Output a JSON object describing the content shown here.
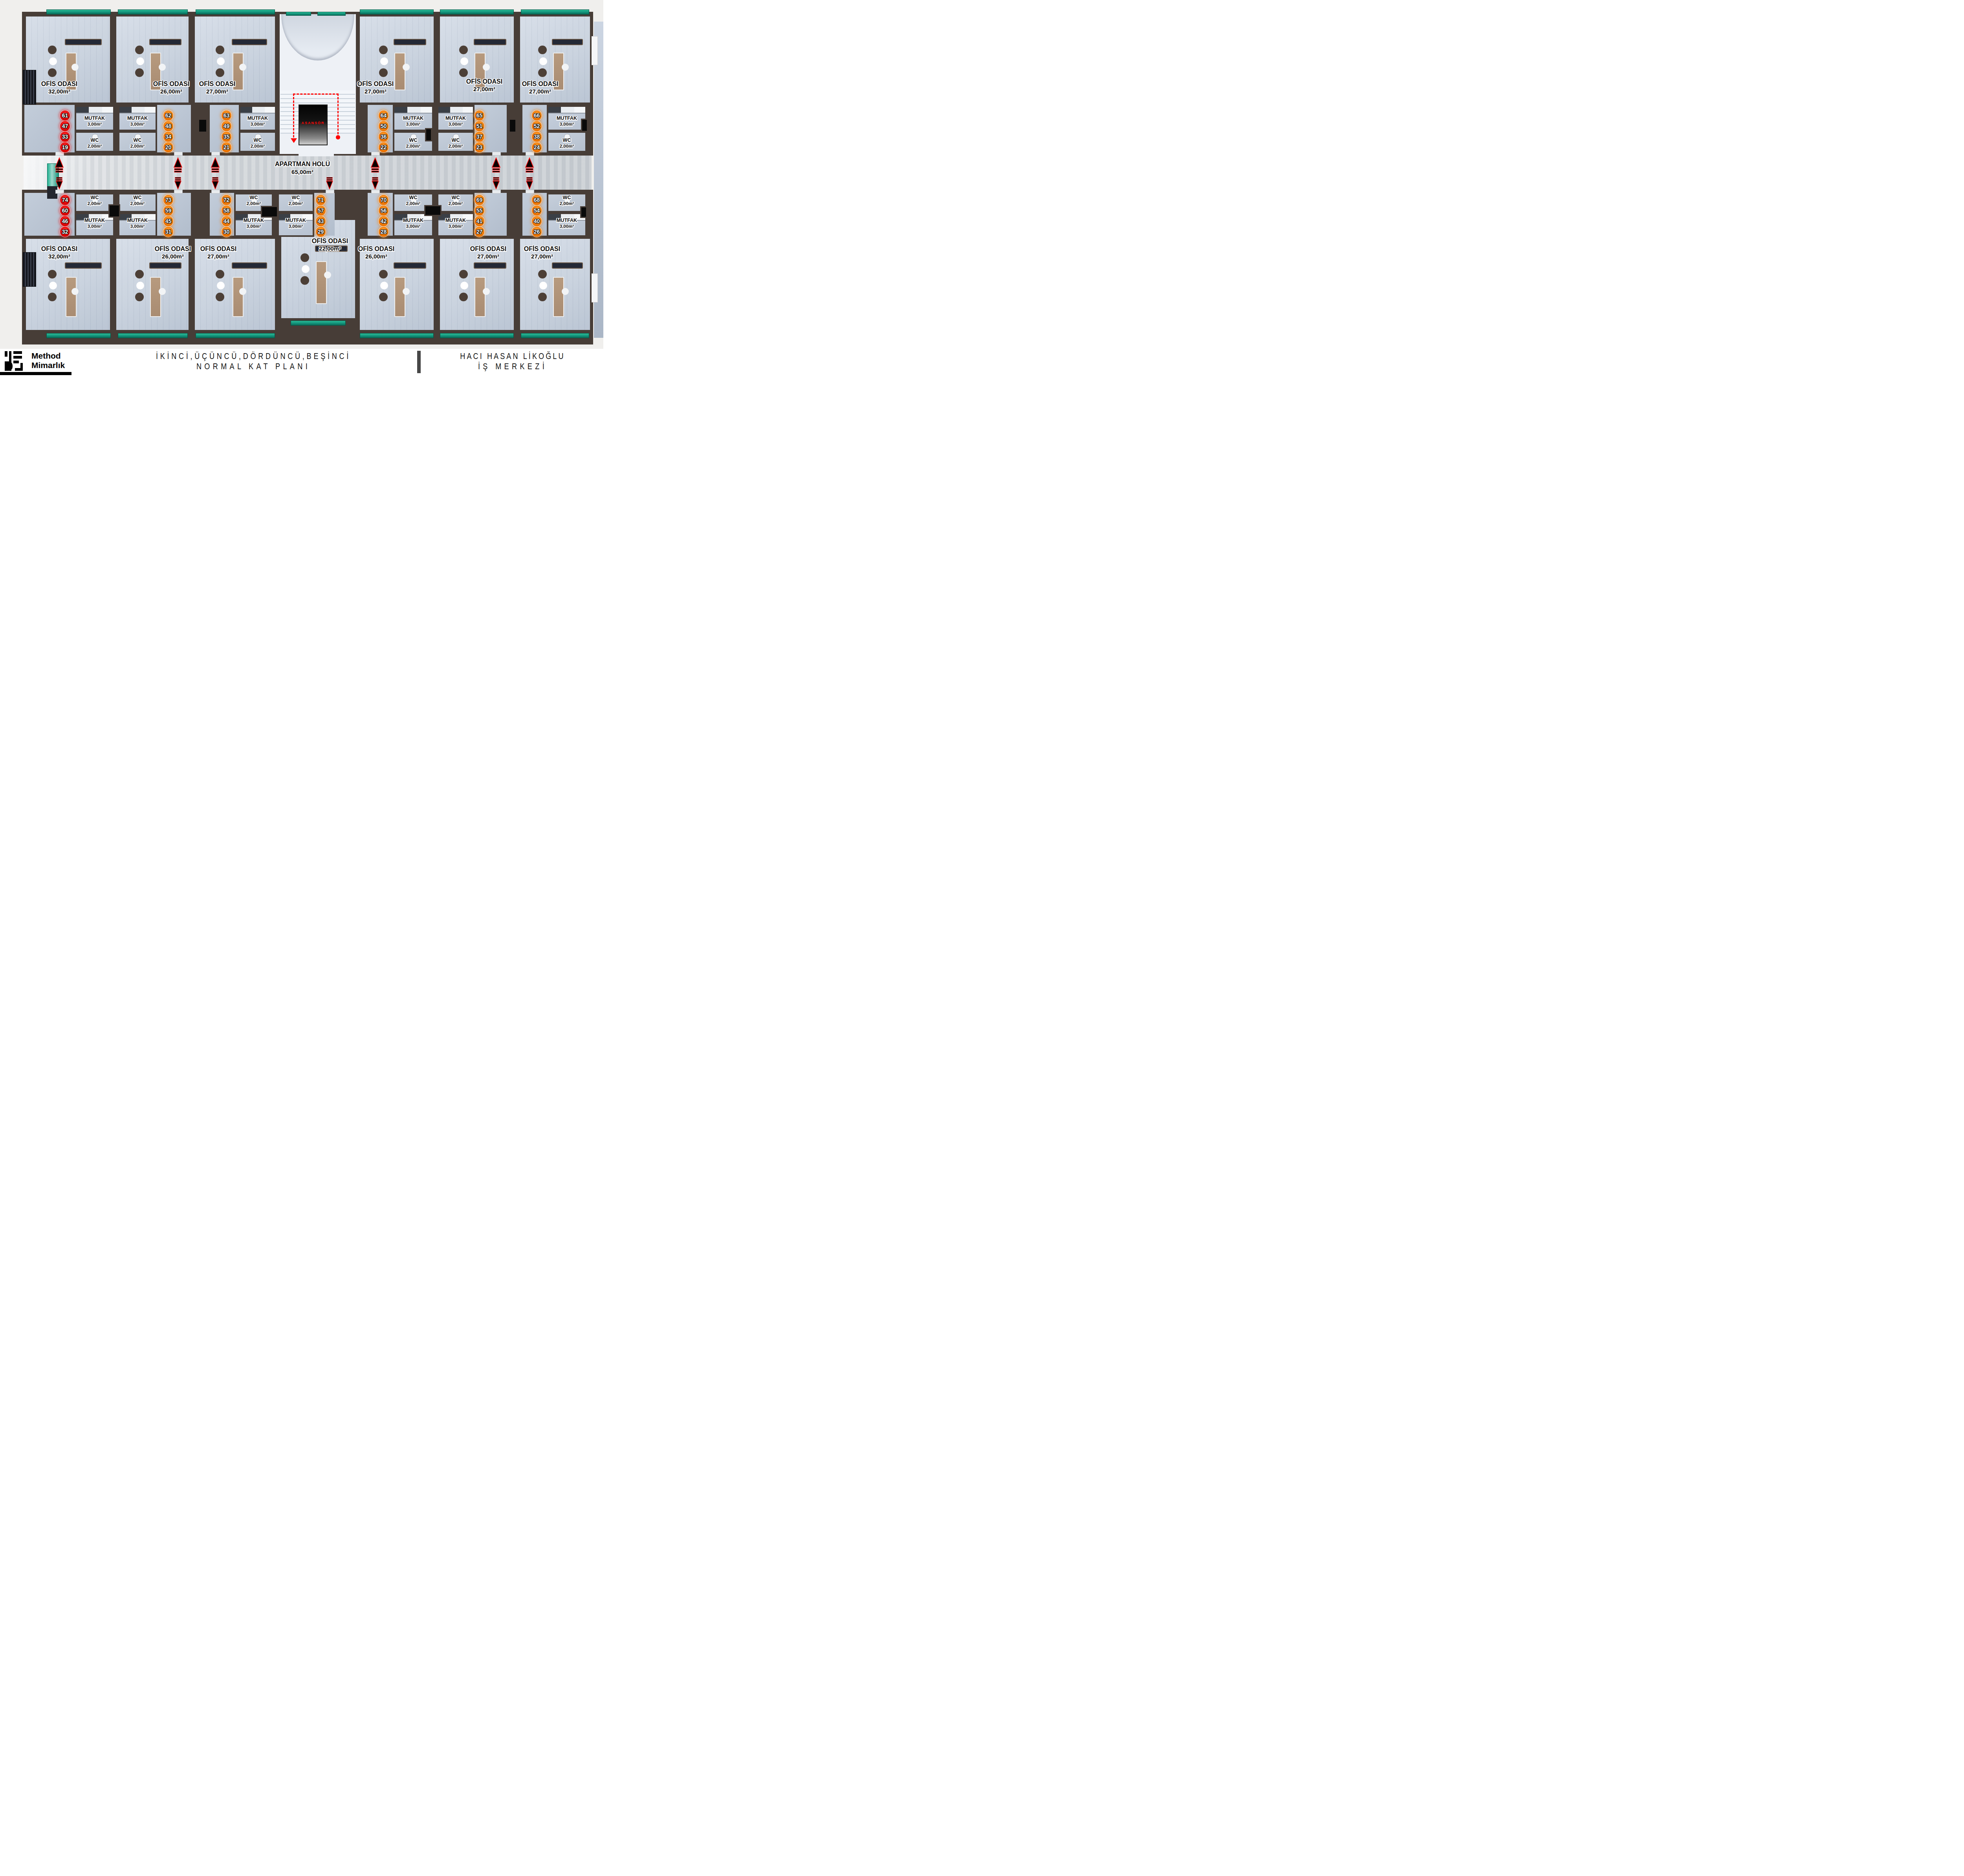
{
  "plan": {
    "corridor": {
      "name": "APARTMAN HOL\u00dc",
      "area": "65,00m\u00b2"
    },
    "elevator_label": "ASANS\u00d6R",
    "room_labels": {
      "office": "OF\u0130S ODASI",
      "kitchen": "MUTFAK",
      "kitchen_area": "3,00m\u00b2",
      "wc": "WC",
      "wc_area": "2,00m\u00b2"
    },
    "units": [
      {
        "position": "top-1",
        "office_area": "32,00m\u00b2",
        "numbers": [
          "61",
          "47",
          "33",
          "19"
        ],
        "chip_color": "red"
      },
      {
        "position": "top-2",
        "office_area": "26,00m\u00b2",
        "numbers": [
          "62",
          "48",
          "34",
          "20"
        ],
        "chip_color": "orange"
      },
      {
        "position": "top-3",
        "office_area": "27,00m\u00b2",
        "numbers": [
          "63",
          "49",
          "35",
          "21"
        ],
        "chip_color": "orange"
      },
      {
        "position": "top-4",
        "office_area": "27,00m\u00b2",
        "numbers": [
          "64",
          "50",
          "36",
          "22"
        ],
        "chip_color": "orange"
      },
      {
        "position": "top-5",
        "office_area": "27,00m\u00b2",
        "numbers": [
          "65",
          "51",
          "37",
          "23"
        ],
        "chip_color": "orange"
      },
      {
        "position": "top-6",
        "office_area": "27,00m\u00b2",
        "numbers": [
          "66",
          "52",
          "38",
          "24"
        ],
        "chip_color": "orange"
      },
      {
        "position": "bottom-1",
        "office_area": "32,00m\u00b2",
        "numbers": [
          "74",
          "60",
          "46",
          "32"
        ],
        "chip_color": "red"
      },
      {
        "position": "bottom-2",
        "office_area": "26,00m\u00b2",
        "numbers": [
          "73",
          "59",
          "45",
          "31"
        ],
        "chip_color": "orange"
      },
      {
        "position": "bottom-3",
        "office_area": "27,00m\u00b2",
        "numbers": [
          "72",
          "58",
          "44",
          "30"
        ],
        "chip_color": "orange"
      },
      {
        "position": "bottom-4",
        "office_area": "22,00m\u00b2",
        "numbers": [
          "71",
          "57",
          "43",
          "29"
        ],
        "chip_color": "orange"
      },
      {
        "position": "bottom-5",
        "office_area": "26,00m\u00b2",
        "numbers": [
          "70",
          "56",
          "42",
          "28"
        ],
        "chip_color": "orange"
      },
      {
        "position": "bottom-6",
        "office_area": "27,00m\u00b2",
        "numbers": [
          "69",
          "55",
          "41",
          "27"
        ],
        "chip_color": "orange"
      },
      {
        "position": "bottom-7",
        "office_area": "27,00m\u00b2",
        "numbers": [
          "68",
          "54",
          "40",
          "26"
        ],
        "chip_color": "orange"
      }
    ],
    "colors": {
      "wall": "#473d37",
      "balcony_teal": "#16a287",
      "chip_red": "#e60000",
      "chip_orange": "#f17c00",
      "arrow": "#ff0000",
      "elevator_text": "#ff1414"
    }
  },
  "footer": {
    "brand_line1": "Method",
    "brand_line2": "Mimarl\u0131k",
    "title_line1": "\u0130K\u0130NC\u0130,\u00dc\u00c7\u00dcNC\u00dc,D\u00d6RD\u00dcNC\u00dc,BE\u015e\u0130NC\u0130",
    "title_line2": "NORMAL KAT PLANI",
    "project_line1": "HACI HASAN L\u0130KO\u011eLU",
    "project_line2": "\u0130\u015e MERKEZ\u0130"
  }
}
